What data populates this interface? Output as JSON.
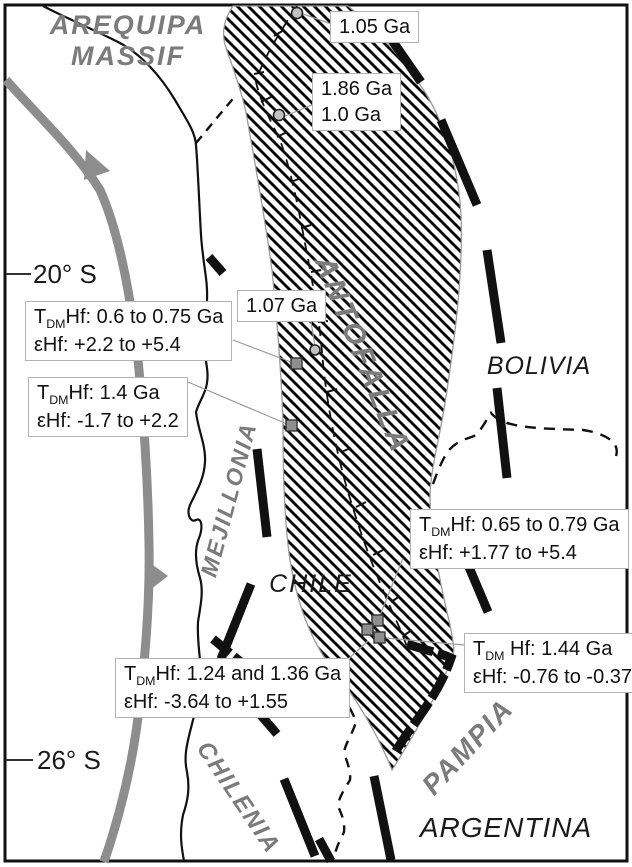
{
  "figure": {
    "type": "geological-terrane-map",
    "region": "Central Andes (Chile / Bolivia / Argentina)"
  },
  "latitudes": {
    "north": "20° S",
    "south": "26° S"
  },
  "terranes": {
    "arequipa_line1": "AREQUIPA",
    "arequipa_line2": "MASSIF",
    "antofalla": "ANTOFALLA",
    "mejillonia": "MEJILLONIA",
    "chilenia": "CHILENIA",
    "pampia": "PAMPIA"
  },
  "countries": {
    "bolivia": "BOLIVIA",
    "chile": "CHILE",
    "argentina": "ARGENTINA"
  },
  "age_labels": [
    {
      "lines": [
        "1.05 Ga"
      ]
    },
    {
      "lines": [
        "1.86 Ga",
        "1.0 Ga"
      ]
    },
    {
      "lines": [
        "1.07 Ga"
      ]
    }
  ],
  "isotope_labels": [
    {
      "line1_prefix": "T",
      "line1_sub": "DM",
      "line1_text": "Hf: 0.6 to 0.75 Ga",
      "line2": "εHf: +2.2 to +5.4"
    },
    {
      "line1_prefix": "T",
      "line1_sub": "DM",
      "line1_text": "Hf: 1.4 Ga",
      "line2": "εHf: -1.7 to +2.2"
    },
    {
      "line1_prefix": "T",
      "line1_sub": "DM",
      "line1_text": "Hf: 0.65 to 0.79 Ga",
      "line2": "εHf: +1.77 to +5.4"
    },
    {
      "line1_prefix": "T",
      "line1_sub": "DM",
      "line1_text": " Hf: 1.44 Ga",
      "line2": "εHf: -0.76 to -0.37"
    },
    {
      "line1_prefix": "T",
      "line1_sub": "DM",
      "line1_text": "Hf: 1.24 and 1.36 Ga",
      "line2": "εHf: -3.64 to +1.55"
    }
  ],
  "markers": {
    "circle_samples": [
      {
        "x": 297,
        "y": 13
      },
      {
        "x": 279,
        "y": 115
      },
      {
        "x": 315,
        "y": 350
      }
    ],
    "square_samples": [
      {
        "x": 297,
        "y": 364
      },
      {
        "x": 292,
        "y": 426
      },
      {
        "x": 378,
        "y": 621
      },
      {
        "x": 368,
        "y": 630
      },
      {
        "x": 380,
        "y": 638
      }
    ]
  },
  "colors": {
    "terrane_text": "#7b7b7b",
    "trench": "#8d8d8d",
    "boundary": "#111111",
    "belt_outline": "#9a9a9a",
    "box_border": "#b2b2b2",
    "marker_square": "#8f8f8f",
    "marker_circle": "#c2c2c2"
  }
}
